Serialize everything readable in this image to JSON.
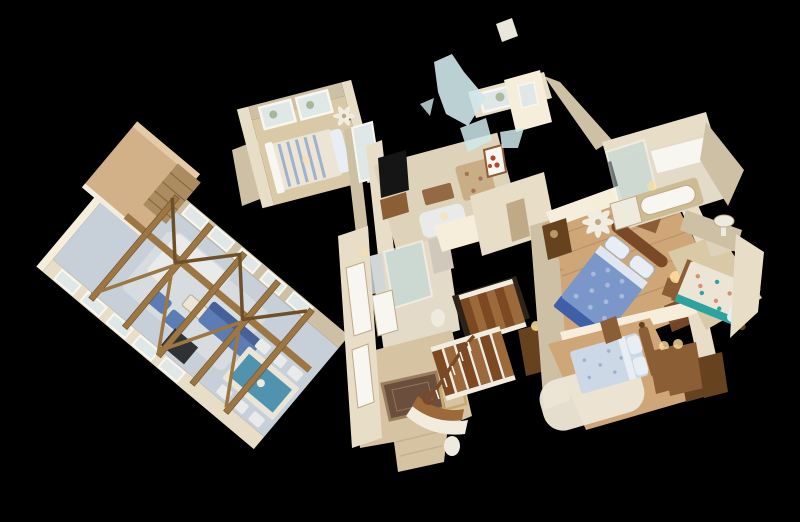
{
  "alt": "Matterport-style 3D dollhouse cutaway view of a home's upper floor floating on a black background: a vaulted great room with exposed wood trusses, brick chimney, blue sofas and a teal-topped dining table on the left wing; a central travertine foyer with an oriental rug and a dark-wood staircase with white risers; a den with wall TV and floral armchair, a glass shower room, and pale-blue translucent ceiling mesh fragments at top center; a master bedroom with blue medallion duvet and arched wood headboard, a second bedroom with pale blue bedding and shaggy rug, a far-right bedroom with teal floral quilt, and a bathroom with soaking tub and glass shower at top right.",
  "palette": {
    "bg": "#000000",
    "wall": "#e8dec8",
    "wallShadow": "#cec0a5",
    "wallBright": "#f6eeda",
    "roof": "#d2b189",
    "roofEdge": "#e4cba6",
    "truss": "#9c7743",
    "trussDark": "#6f4f27",
    "brick": "#aa8c60",
    "brickDark": "#87693f",
    "greatFloor": "#c7cfd8",
    "rugGray": "#d6dce0",
    "sofaWhite": "#e9eaea",
    "sofaBlue": "#5c7cb4",
    "sofaBlueDark": "#46609a",
    "tableTeal": "#4f93ae",
    "tableWhite": "#ebe5d8",
    "woodFloor": "#cfa678",
    "woodFloorDark": "#a87e50",
    "woodFloorPale": "#d9c9a6",
    "stairTread": "#7c4922",
    "stairMid": "#9c6a3a",
    "stairWhite": "#f2ecdf",
    "voidDark": "#2e2318",
    "travertine": "#d5c3a2",
    "travertineDark": "#bfa987",
    "rugBrown": "#6b4e3c",
    "rugBorder": "#9a7e60",
    "duvetBlue": "#7b97c9",
    "duvetDot": "#a7bade",
    "skirtBlue": "#3f5fa8",
    "pillowWhite": "#e9eef5",
    "headboard": "#7a4a28",
    "furnWood": "#8b5e36",
    "furnWoodDark": "#66421f",
    "paleBlueBed": "#ccd8e6",
    "paleBedDot": "#9fb2cc",
    "quiltCream": "#ece5d6",
    "quiltTeal": "#2ba39e",
    "quiltCoral": "#d98f73",
    "glassAqua": "#bcd8da",
    "shardBlue": "#cfe7ea",
    "fanWhite": "#f0ece1",
    "tvBlack": "#151515",
    "lampGlow": "#ffdf9e",
    "tileCream": "#e3dbc8",
    "carpetTan": "#ded3ba",
    "glassWindow": "#dfe8e6",
    "frameWhite": "#f8f6f0",
    "artRed": "#b5452f",
    "chairFloral": "#c9ad85",
    "chairDot": "#a5735a",
    "goldTable": "#c9a96a",
    "mirrorGlass": "#ccd6d8",
    "statueWhite": "#efeade",
    "fragmentWhite": "#eae6da",
    "treeGreen": "#8fa07a",
    "tubDeck": "#cdbb93",
    "marble": "#cfc8bb"
  }
}
